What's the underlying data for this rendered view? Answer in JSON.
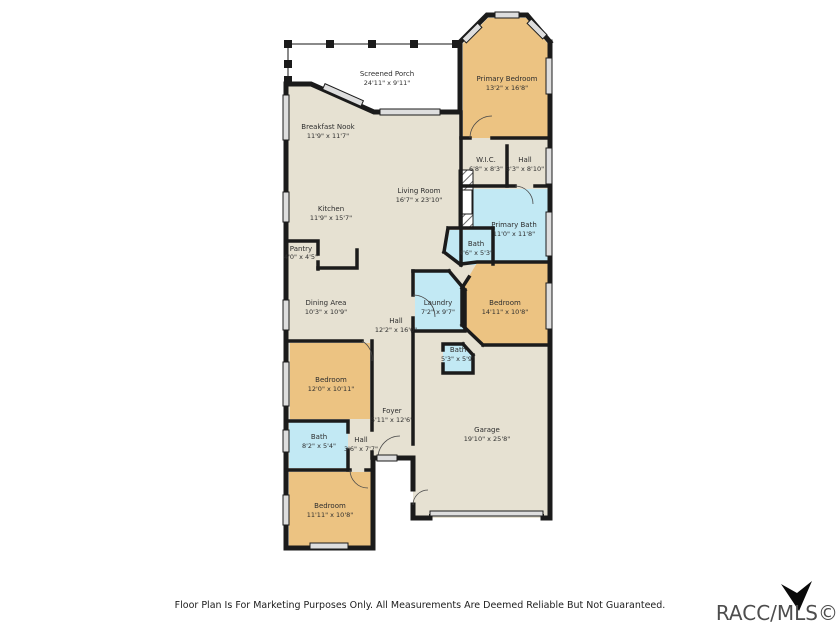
{
  "plan": {
    "disclaimer": "Floor Plan Is For Marketing Purposes Only. All Measurements Are Deemed Reliable But Not Guaranteed.",
    "watermark": "RACC/MLS©",
    "colors": {
      "floor": "#e6e1d2",
      "bedroom": "#ecc382",
      "bath": "#c2e9f4",
      "porch": "#ffffff",
      "wall": "#1b1b1b",
      "window": "#dedede"
    },
    "rooms": [
      {
        "name": "Screened Porch",
        "dims": "24'11\" x 9'11\""
      },
      {
        "name": "Primary Bedroom",
        "dims": "13'2\" x 16'8\""
      },
      {
        "name": "Breakfast Nook",
        "dims": "11'9\" x 11'7\""
      },
      {
        "name": "W.I.C.",
        "dims": "6'8\" x 8'3\""
      },
      {
        "name": "Hall",
        "dims": "3'3\" x 8'10\""
      },
      {
        "name": "Living Room",
        "dims": "16'7\" x 23'10\""
      },
      {
        "name": "Kitchen",
        "dims": "11'9\" x 15'7\""
      },
      {
        "name": "Pantry",
        "dims": "4'0\" x 4'5\""
      },
      {
        "name": "Primary Bath",
        "dims": "11'0\" x 11'8\""
      },
      {
        "name": "Bath",
        "dims": "4'6\" x 5'3\""
      },
      {
        "name": "Dining Area",
        "dims": "10'3\" x 10'9\""
      },
      {
        "name": "Laundry",
        "dims": "7'2\" x 9'7\""
      },
      {
        "name": "Bedroom",
        "dims": "14'11\" x 10'8\""
      },
      {
        "name": "Hall",
        "dims": "12'2\" x 16'0\""
      },
      {
        "name": "Bath",
        "dims": "5'3\" x 5'9\""
      },
      {
        "name": "Bedroom",
        "dims": "12'0\" x 10'11\""
      },
      {
        "name": "Foyer",
        "dims": "5'11\" x 12'6\""
      },
      {
        "name": "Bath",
        "dims": "8'2\" x 5'4\""
      },
      {
        "name": "Hall",
        "dims": "3'6\" x 7'7\""
      },
      {
        "name": "Garage",
        "dims": "19'10\" x 25'8\""
      },
      {
        "name": "Bedroom",
        "dims": "11'11\" x 10'8\""
      }
    ]
  }
}
